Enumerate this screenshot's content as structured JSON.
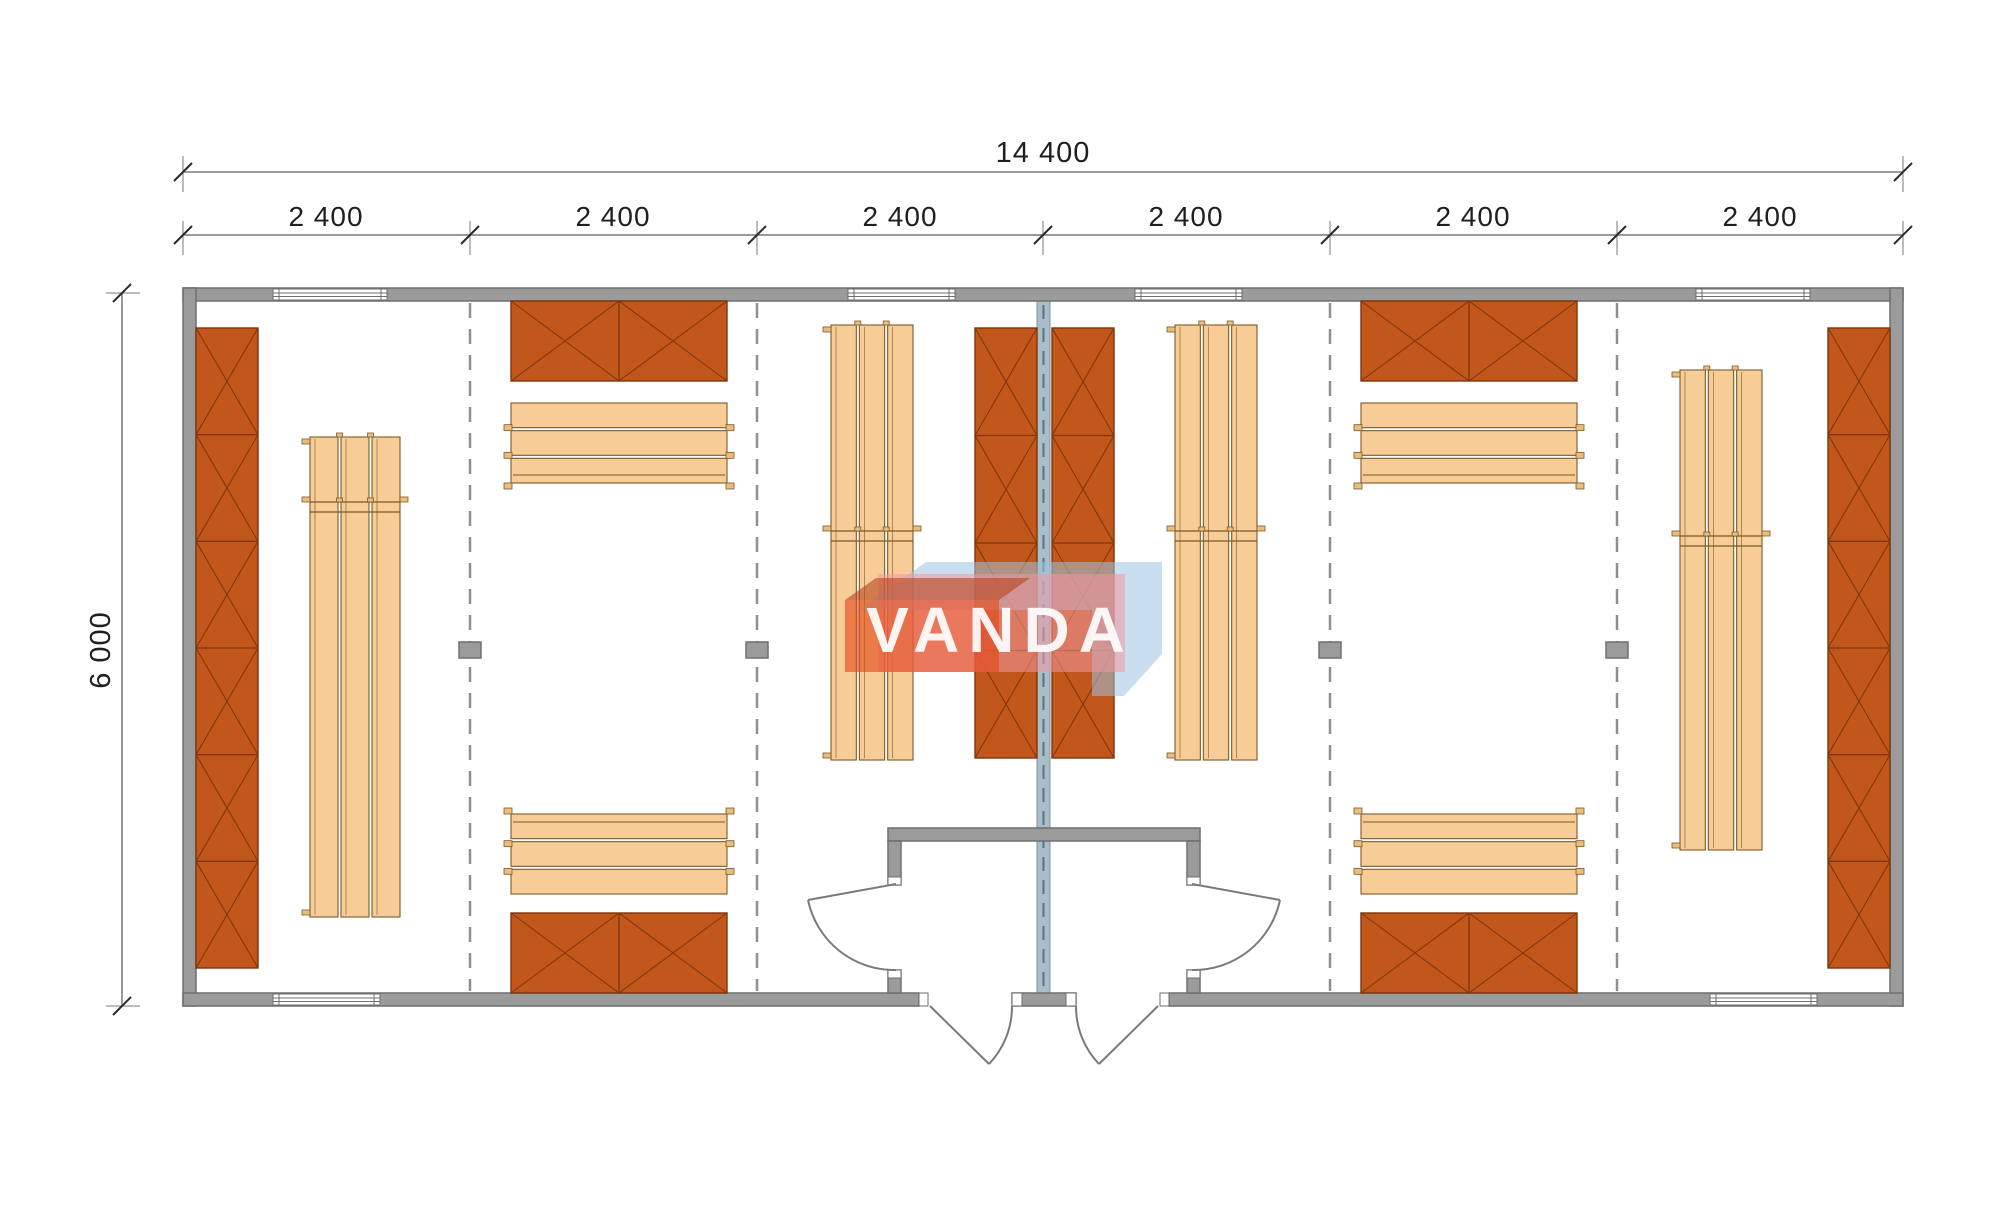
{
  "plan": {
    "dimensions": {
      "total_width_label": "14 400",
      "height_label": "6 000",
      "modules": [
        {
          "label": "2 400"
        },
        {
          "label": "2 400"
        },
        {
          "label": "2 400"
        },
        {
          "label": "2 400"
        },
        {
          "label": "2 400"
        },
        {
          "label": "2 400"
        }
      ]
    },
    "watermark": {
      "text": "VANDA"
    },
    "colors": {
      "wall": "#9b9b9b",
      "wallStroke": "#6f6f6f",
      "centerWall": "#a9bec9",
      "centerWallStroke": "#7d93a0",
      "centerWallDash": "#5c7482",
      "panel": "#c1571b",
      "panelStroke": "#7d350c",
      "plank": "#f8cc96",
      "plankStroke": "#7a5a28",
      "tab": "#e9bd7e",
      "dashedLine": "#8f8f8f",
      "dimLine": "#787878",
      "dimText": "#1f1f1f",
      "door": "#7a7a7a",
      "window": "#ffffff",
      "wmBlue": "#9cc3e2",
      "wmPink": "#f2989e",
      "wmRed": "#e2491a",
      "wmRedTop": "#b8431c",
      "wmText": "#ffffff"
    }
  }
}
